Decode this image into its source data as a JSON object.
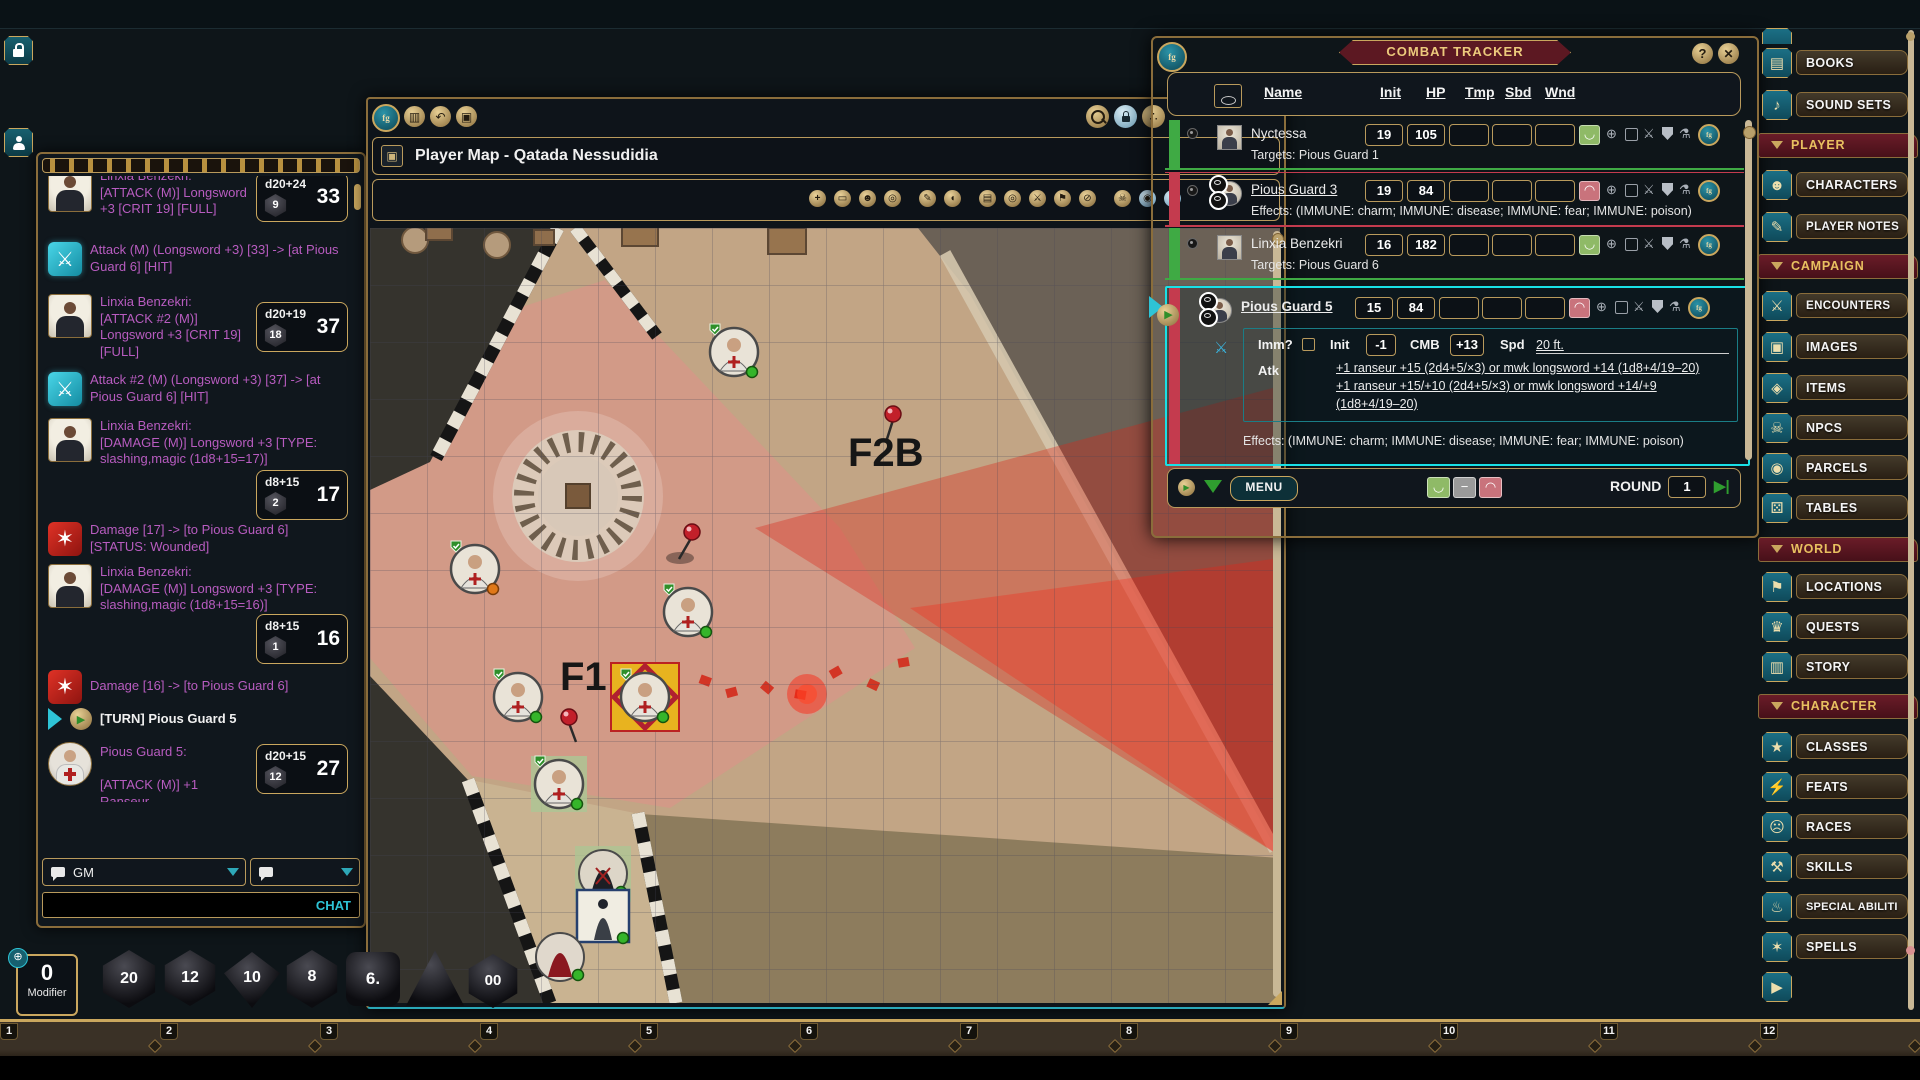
{
  "icons": {
    "play": "▶",
    "down": "▼",
    "next": "▶|",
    "undo": "↶",
    "cols": "▥",
    "copy": "▣",
    "share": "∴",
    "help": "?",
    "close": "✕",
    "title_tab": "▣",
    "tracker_target": "⊕",
    "tracker_sword": "⚔",
    "tracker_flask": "⚗",
    "smile": "◡",
    "frown": "◠",
    "fg": "fg",
    "attack": "⚔",
    "damage": "✶",
    "minus": "−",
    "tools": [
      "+",
      "▭",
      "☻",
      "◎",
      "✎",
      "◖",
      "▤",
      "◎",
      "⚔",
      "⚑",
      "⊘",
      "☠",
      "◉",
      "◔"
    ]
  },
  "chat": {
    "messages": [
      {
        "speaker": "Linxia Benzekri:",
        "text": "[ATTACK (M)] Longsword +3 [CRIT 19] [FULL]",
        "dice": {
          "formula": "d20+24",
          "die": "9",
          "total": "33"
        }
      },
      {
        "text": "Attack (M) (Longsword +3) [33] -> [at Pious Guard 6] [HIT]"
      },
      {
        "speaker": "Linxia Benzekri:",
        "text": "[ATTACK #2 (M)] Longsword +3 [CRIT 19] [FULL]",
        "dice": {
          "formula": "d20+19",
          "die": "18",
          "total": "37"
        }
      },
      {
        "text": "Attack #2 (M) (Longsword +3) [37] -> [at Pious Guard 6] [HIT]"
      },
      {
        "speaker": "Linxia Benzekri:",
        "text": "[DAMAGE (M)] Longsword +3 [TYPE: slashing,magic (1d8+15=17)]",
        "dice": {
          "formula": "d8+15",
          "die": "2",
          "total": "17"
        }
      },
      {
        "text": "Damage [17] -> [to Pious Guard 6] [STATUS: Wounded]"
      },
      {
        "speaker": "Linxia Benzekri:",
        "text": "[DAMAGE (M)] Longsword +3 [TYPE: slashing,magic (1d8+15=16)]",
        "dice": {
          "formula": "d8+15",
          "die": "1",
          "total": "16"
        }
      },
      {
        "text": "Damage [16] -> [to Pious Guard 6]"
      },
      {
        "text": "[TURN] Pious Guard 5"
      },
      {
        "speaker": "Pious Guard 5:",
        "text": "[ATTACK (M)] +1 Ranseur",
        "dice": {
          "formula": "d20+15",
          "die": "12",
          "total": "27"
        }
      },
      {
        "text": "Attack (M) (+1 Ranseur) [27] -> [at Linxia Benzekri] [MISS]"
      }
    ],
    "channel": "GM",
    "input_label": "CHAT"
  },
  "map": {
    "title": "Player Map - Qatada Nessudidia",
    "labels": {
      "f1": "F1",
      "f2b": "F2B"
    }
  },
  "tracker": {
    "title": "COMBAT TRACKER",
    "columns": {
      "name": "Name",
      "init": "Init",
      "hp": "HP",
      "tmp": "Tmp",
      "sbd": "Sbd",
      "wnd": "Wnd"
    },
    "rows": [
      {
        "name": "Nyctessa",
        "init": "19",
        "hp": "105",
        "sub": "Targets: Pious Guard 1"
      },
      {
        "name": "Pious Guard 3",
        "init": "19",
        "hp": "84",
        "sub": "Effects: (IMMUNE: charm; IMMUNE: disease; IMMUNE: fear; IMMUNE: poison)"
      },
      {
        "name": "Linxia Benzekri",
        "init": "16",
        "hp": "182",
        "sub": "Targets: Pious Guard 6"
      },
      {
        "name": "Pious Guard 5",
        "init": "15",
        "hp": "84",
        "sub": "Effects: (IMMUNE: charm; IMMUNE: disease; IMMUNE: fear; IMMUNE: poison)",
        "details": {
          "imm_label": "Imm?",
          "init_label": "Init",
          "init_value": "-1",
          "cmb_label": "CMB",
          "cmb_value": "+13",
          "spd_label": "Spd",
          "spd_value": "20 ft.",
          "atk_label": "Atk",
          "atk_line1": "+1 ranseur +15 (2d4+5/×3) or mwk longsword +14 (1d8+4/19–20)",
          "atk_line2": "+1 ranseur +15/+10 (2d4+5/×3) or mwk longsword +14/+9",
          "atk_line3": "(1d8+4/19–20)"
        }
      }
    ],
    "footer": {
      "menu": "MENU",
      "round_label": "ROUND",
      "round_value": "1"
    }
  },
  "sidebar": {
    "items": [
      {
        "label": "BOOKS",
        "icon": "▤"
      },
      {
        "label": "SOUND SETS",
        "icon": "♪"
      },
      {
        "label": "PLAYER"
      },
      {
        "label": "CHARACTERS",
        "icon": "☻"
      },
      {
        "label": "PLAYER NOTES",
        "icon": "✎"
      },
      {
        "label": "CAMPAIGN"
      },
      {
        "label": "ENCOUNTERS",
        "icon": "⚔"
      },
      {
        "label": "IMAGES",
        "icon": "▣"
      },
      {
        "label": "ITEMS",
        "icon": "◈"
      },
      {
        "label": "NPCS",
        "icon": "☠"
      },
      {
        "label": "PARCELS",
        "icon": "◉"
      },
      {
        "label": "TABLES",
        "icon": "⚄"
      },
      {
        "label": "WORLD"
      },
      {
        "label": "LOCATIONS",
        "icon": "⚑"
      },
      {
        "label": "QUESTS",
        "icon": "♛"
      },
      {
        "label": "STORY",
        "icon": "▥"
      },
      {
        "label": "CHARACTER"
      },
      {
        "label": "CLASSES",
        "icon": "★"
      },
      {
        "label": "FEATS",
        "icon": "⚡"
      },
      {
        "label": "RACES",
        "icon": "☹"
      },
      {
        "label": "SKILLS",
        "icon": "⚒"
      },
      {
        "label": "SPECIAL ABILITI",
        "icon": "♨"
      },
      {
        "label": "SPELLS",
        "icon": "✶"
      },
      {
        "label": "",
        "icon": "▶"
      }
    ]
  },
  "dice_bar": {
    "modifier_value": "0",
    "modifier_label": "Modifier",
    "d20": "20",
    "d12": "12",
    "d10": "10",
    "d8": "8",
    "d6": "6.",
    "d100": "00"
  },
  "hotkeys": [
    "1",
    "2",
    "3",
    "4",
    "5",
    "6",
    "7",
    "8",
    "9",
    "10",
    "11",
    "12"
  ]
}
